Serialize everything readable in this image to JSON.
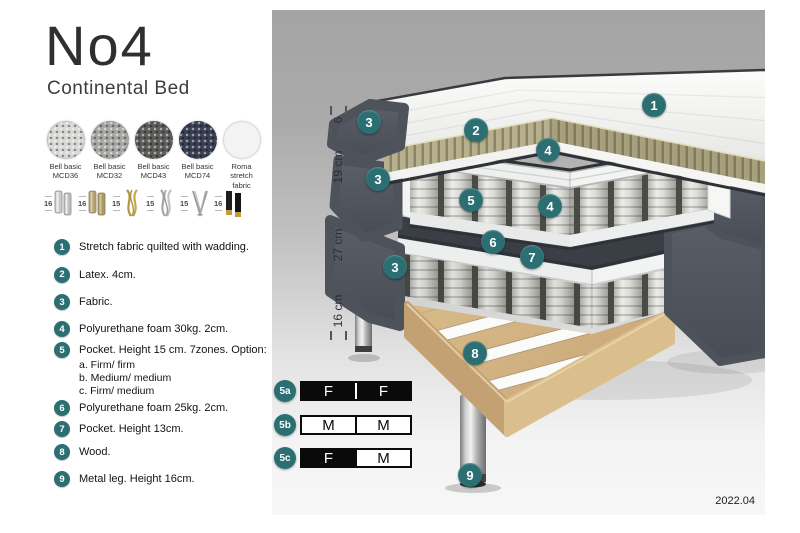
{
  "header": {
    "title": "No4",
    "subtitle": "Continental Bed"
  },
  "fabric_options": [
    {
      "line1": "Bell basic",
      "line2": "MCD36",
      "color": "#d8d8d6"
    },
    {
      "line1": "Bell basic",
      "line2": "MCD32",
      "color": "#a7a7a5"
    },
    {
      "line1": "Bell basic",
      "line2": "MCD43",
      "color": "#5c5c5a"
    },
    {
      "line1": "Bell basic",
      "line2": "MCD74",
      "color": "#3b3f54"
    },
    {
      "line1": "Roma",
      "line2": "stretch fabric",
      "color": "#f3f3f3"
    }
  ],
  "leg_options": [
    {
      "height": "16",
      "style": "cylinder chrome pair"
    },
    {
      "height": "16",
      "style": "cylinder brass pair"
    },
    {
      "height": "15",
      "style": "twisted gold"
    },
    {
      "height": "15",
      "style": "twisted silver"
    },
    {
      "height": "15",
      "style": "hairpin steel"
    },
    {
      "height": "16",
      "style": "black with brass foot"
    }
  ],
  "parts": [
    {
      "num": "1",
      "text": "Stretch fabric quilted with wadding."
    },
    {
      "num": "2",
      "text": "Latex. 4cm."
    },
    {
      "num": "3",
      "text": "Fabric."
    },
    {
      "num": "4",
      "text": "Polyurethane foam 30kg. 2cm."
    },
    {
      "num": "5",
      "text": "Pocket. Height 15 cm. 7zones. Option:",
      "options": [
        "a. Firm/ firm",
        "b. Medium/ medium",
        "c. Firm/ medium"
      ]
    },
    {
      "num": "6",
      "text": "Polyurethane foam 25kg. 2cm."
    },
    {
      "num": "7",
      "text": "Pocket. Height 13cm."
    },
    {
      "num": "8",
      "text": "Wood."
    },
    {
      "num": "9",
      "text": "Metal leg. Height 16cm."
    }
  ],
  "diagram": {
    "callouts": [
      {
        "label": "1"
      },
      {
        "label": "2"
      },
      {
        "label": "3"
      },
      {
        "label": "3"
      },
      {
        "label": "3"
      },
      {
        "label": "4"
      },
      {
        "label": "5"
      },
      {
        "label": "4"
      },
      {
        "label": "6"
      },
      {
        "label": "7"
      },
      {
        "label": "8"
      },
      {
        "label": "9"
      }
    ],
    "dimensions": [
      {
        "label": "6"
      },
      {
        "label": "19 cm"
      },
      {
        "label": "27 cm"
      },
      {
        "label": "16 cm"
      }
    ],
    "version": "2022.04"
  },
  "firmness_options": [
    {
      "id": "5a",
      "cells": [
        {
          "letter": "F",
          "fill": "#0a0a0a",
          "text_color": "#ffffff"
        },
        {
          "letter": "F",
          "fill": "#0a0a0a",
          "text_color": "#ffffff"
        }
      ]
    },
    {
      "id": "5b",
      "cells": [
        {
          "letter": "M",
          "fill": "#ffffff",
          "text_color": "#0a0a0a"
        },
        {
          "letter": "M",
          "fill": "#ffffff",
          "text_color": "#0a0a0a"
        }
      ]
    },
    {
      "id": "5c",
      "cells": [
        {
          "letter": "F",
          "fill": "#0a0a0a",
          "text_color": "#ffffff"
        },
        {
          "letter": "M",
          "fill": "#ffffff",
          "text_color": "#0a0a0a"
        }
      ]
    }
  ],
  "colors": {
    "accent_teal": "#2c6f73",
    "latex": "#b7b08e",
    "wood": "#d3b585",
    "dark_fabric": "#50555e",
    "panel_top": "#a4a4a4",
    "panel_bottom": "#f7f7f7"
  }
}
